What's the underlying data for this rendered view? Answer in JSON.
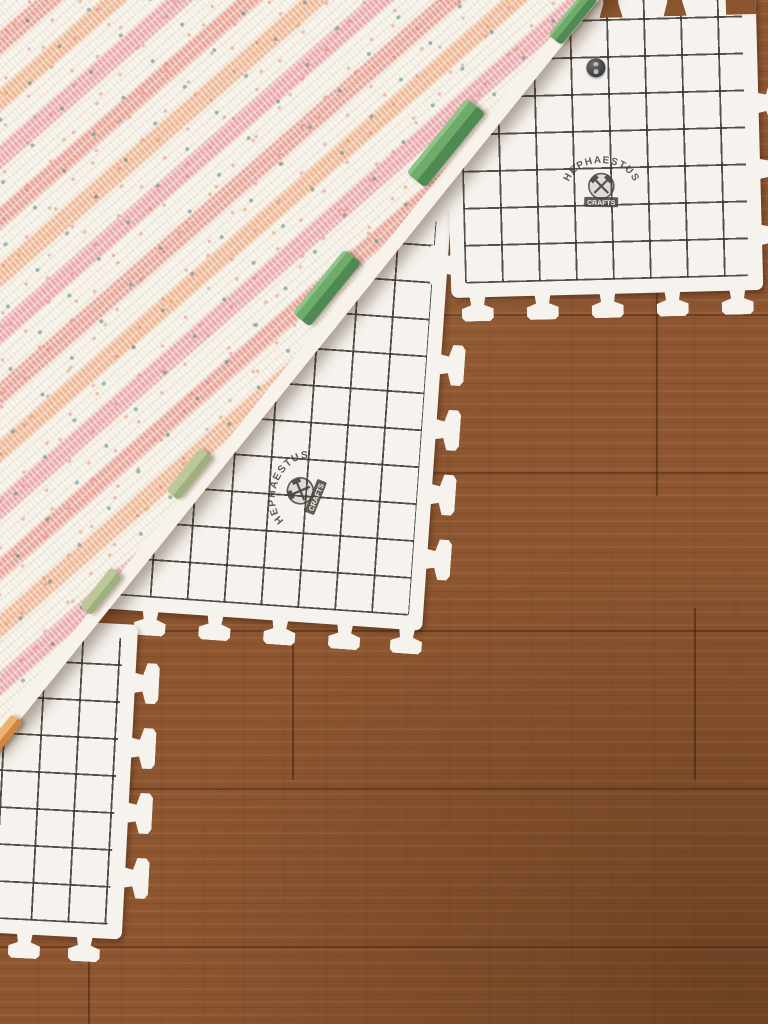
{
  "scene": {
    "subject": "Striped crochet blanket pinned for blocking on white grid blocking mats laid over a hardwood floor",
    "counts": {
      "mats_visible": 3,
      "blocker_clips": 6,
      "brand_logos": 2,
      "metal_snaps": 1
    }
  },
  "brand": {
    "arc_text": "HEPHAESTUS",
    "banner_text": "CRAFTS"
  },
  "colors": {
    "wood_base": "#8d5630",
    "wood_seam": "#381b0a",
    "mat_surface": "#f6f3ee",
    "grid_line": "#3c3830",
    "blanket_cream": "#f4efe4",
    "stripe_pink": "#ecaab0",
    "stripe_peach": "#f1b896",
    "stripe_rose": "#eaa69c",
    "speckle_teal": "#3a7d78",
    "speckle_orange": "#e18c46",
    "clip_green": "#5d9b5c",
    "clip_sage": "#a9b985",
    "clip_orange": "#dd8f4a",
    "logo_ink": "#45413b",
    "snap_gray": "#3c3c40"
  }
}
